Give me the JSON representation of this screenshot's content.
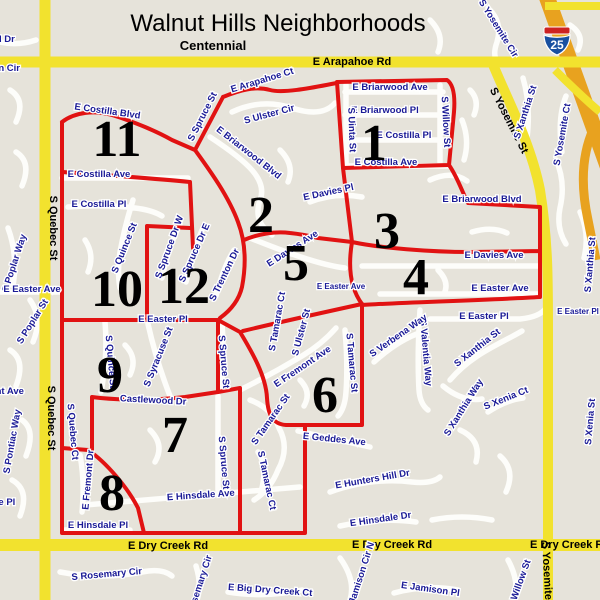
{
  "title": "Walnut Hills Neighborhoods",
  "subtitle": "Centennial",
  "interstate_shield": "25",
  "colors": {
    "background": "#e6e3da",
    "road_yellow": "#f2e22e",
    "highway_orange": "#e8a21f",
    "boundary_red": "#e11212",
    "street_label_blue": "#1a1a96",
    "shield_blue": "#1950a0",
    "shield_red": "#cc2222"
  },
  "regions": [
    {
      "number": "1",
      "x": 374,
      "y": 160
    },
    {
      "number": "2",
      "x": 261,
      "y": 232
    },
    {
      "number": "3",
      "x": 387,
      "y": 248
    },
    {
      "number": "4",
      "x": 416,
      "y": 294
    },
    {
      "number": "5",
      "x": 296,
      "y": 280
    },
    {
      "number": "6",
      "x": 325,
      "y": 412
    },
    {
      "number": "7",
      "x": 175,
      "y": 452
    },
    {
      "number": "8",
      "x": 112,
      "y": 510
    },
    {
      "number": "9",
      "x": 110,
      "y": 392
    },
    {
      "number": "10",
      "x": 117,
      "y": 306
    },
    {
      "number": "11",
      "x": 117,
      "y": 156
    },
    {
      "number": "12",
      "x": 184,
      "y": 303
    }
  ],
  "labels": [
    {
      "t": "Walnut Hills Neighborhoods",
      "x": 278,
      "y": 31,
      "r": 0,
      "c": "title"
    },
    {
      "t": "Centennial",
      "x": 213,
      "y": 50,
      "r": 0,
      "c": "sub"
    },
    {
      "t": "E Arapahoe Rd",
      "x": 352,
      "y": 65,
      "r": 0,
      "c": "maj"
    },
    {
      "t": "E Dry Creek Rd",
      "x": 168,
      "y": 549,
      "r": 0,
      "c": "maj"
    },
    {
      "t": "E Dry Creek Rd",
      "x": 392,
      "y": 548,
      "r": 0,
      "c": "maj"
    },
    {
      "t": "E Dry Creek Rd",
      "x": 570,
      "y": 548,
      "r": 0,
      "c": "maj",
      "a": "s"
    },
    {
      "t": "S Quebec St",
      "x": 50,
      "y": 228,
      "r": 90,
      "c": "maj"
    },
    {
      "t": "S Quebec St",
      "x": 48,
      "y": 418,
      "r": 90,
      "c": "maj"
    },
    {
      "t": "S Yosemite St",
      "x": 506,
      "y": 122,
      "r": 63,
      "c": "maj"
    },
    {
      "t": "S Yosemite St",
      "x": 544,
      "y": 578,
      "r": 87,
      "c": "maj"
    },
    {
      "t": "ld Dr",
      "x": 4,
      "y": 42,
      "r": 0,
      "a": "s"
    },
    {
      "t": "cton Cir",
      "x": 2,
      "y": 71,
      "r": 0,
      "a": "s"
    },
    {
      "t": "E Briarwood Ave",
      "x": 390,
      "y": 90,
      "r": 0
    },
    {
      "t": "E Briarwood Pl",
      "x": 385,
      "y": 113,
      "r": 0
    },
    {
      "t": "E Costilla Pl",
      "x": 404,
      "y": 138,
      "r": 0
    },
    {
      "t": "E Costilla Ave",
      "x": 386,
      "y": 165,
      "r": 0
    },
    {
      "t": "S Uinta St",
      "x": 349,
      "y": 130,
      "r": 88
    },
    {
      "t": "S Willow St",
      "x": 443,
      "y": 122,
      "r": 87
    },
    {
      "t": "S Xanthia St",
      "x": 528,
      "y": 113,
      "r": -72
    },
    {
      "t": "S Yosemite Ct",
      "x": 565,
      "y": 135,
      "r": -80
    },
    {
      "t": "S Yosemite Cir",
      "x": 496,
      "y": 30,
      "r": 58
    },
    {
      "t": "E Arapahoe Ct",
      "x": 263,
      "y": 83,
      "r": -17
    },
    {
      "t": "S Spruce St",
      "x": 205,
      "y": 118,
      "r": -63
    },
    {
      "t": "S Ulster Cir",
      "x": 270,
      "y": 117,
      "r": -15
    },
    {
      "t": "E Briarwood Blvd",
      "x": 247,
      "y": 155,
      "r": 38
    },
    {
      "t": "E Davies Pl",
      "x": 329,
      "y": 195,
      "r": -12
    },
    {
      "t": "E Briarwood Blvd",
      "x": 482,
      "y": 202,
      "r": 0
    },
    {
      "t": "E Davies Ave",
      "x": 494,
      "y": 258,
      "r": 0
    },
    {
      "t": "E Easter Ave",
      "x": 500,
      "y": 291,
      "r": 0
    },
    {
      "t": "E Easter Pl",
      "x": 484,
      "y": 319,
      "r": 0
    },
    {
      "t": "E Easter Pl",
      "x": 578,
      "y": 314,
      "r": 0,
      "c": "sm"
    },
    {
      "t": "E Davies Ave",
      "x": 294,
      "y": 251,
      "r": -33
    },
    {
      "t": "E Easter Ave",
      "x": 341,
      "y": 289,
      "r": 0,
      "c": "sm"
    },
    {
      "t": "S Tamarac Ct",
      "x": 280,
      "y": 322,
      "r": -80
    },
    {
      "t": "S Ulster St",
      "x": 304,
      "y": 333,
      "r": -75
    },
    {
      "t": "E Costilla Blvd",
      "x": 107,
      "y": 114,
      "r": 8
    },
    {
      "t": "E Costilla Ave",
      "x": 99,
      "y": 177,
      "r": 0
    },
    {
      "t": "E Costilla Pl",
      "x": 99,
      "y": 207,
      "r": 0
    },
    {
      "t": "S Quince St",
      "x": 127,
      "y": 249,
      "r": -68
    },
    {
      "t": "S Spruce Dr W",
      "x": 172,
      "y": 248,
      "r": -70
    },
    {
      "t": "S Spruce Dr E",
      "x": 197,
      "y": 254,
      "r": -66
    },
    {
      "t": "S Trenton Dr",
      "x": 227,
      "y": 276,
      "r": -64
    },
    {
      "t": "S Poplar Way",
      "x": 17,
      "y": 264,
      "r": -72
    },
    {
      "t": "S Poplar St",
      "x": 35,
      "y": 323,
      "r": -58
    },
    {
      "t": "E Easter Ave",
      "x": 32,
      "y": 292,
      "r": 0
    },
    {
      "t": "amont Ave",
      "x": 0,
      "y": 394,
      "r": 0,
      "a": "s"
    },
    {
      "t": "S Pontiac Way",
      "x": 15,
      "y": 442,
      "r": -80
    },
    {
      "t": "S Quebec Ct",
      "x": 70,
      "y": 432,
      "r": 85
    },
    {
      "t": "dale Pl",
      "x": 0,
      "y": 505,
      "r": 0,
      "a": "s"
    },
    {
      "t": "E Easter Pl",
      "x": 163,
      "y": 322,
      "r": 0
    },
    {
      "t": "S Quince St",
      "x": 108,
      "y": 362,
      "r": 85
    },
    {
      "t": "S Syracuse St",
      "x": 161,
      "y": 358,
      "r": -68
    },
    {
      "t": "S Spruce St",
      "x": 221,
      "y": 362,
      "r": 85
    },
    {
      "t": "Castlewood Dr",
      "x": 153,
      "y": 403,
      "r": 3
    },
    {
      "t": "E Fremont Ave",
      "x": 304,
      "y": 369,
      "r": -34
    },
    {
      "t": "E Fremont Dr",
      "x": 91,
      "y": 480,
      "r": -85
    },
    {
      "t": "S Tamarac St",
      "x": 273,
      "y": 421,
      "r": -55
    },
    {
      "t": "S Tamarac St",
      "x": 349,
      "y": 363,
      "r": 85
    },
    {
      "t": "S Tamarac Ct",
      "x": 264,
      "y": 481,
      "r": 78
    },
    {
      "t": "S Spruce St",
      "x": 221,
      "y": 463,
      "r": 85
    },
    {
      "t": "E Hinsdale Ave",
      "x": 201,
      "y": 498,
      "r": -4
    },
    {
      "t": "E Hinsdale Pl",
      "x": 98,
      "y": 528,
      "r": 0
    },
    {
      "t": "E Geddes Ave",
      "x": 334,
      "y": 442,
      "r": 6
    },
    {
      "t": "S Valentia Way",
      "x": 423,
      "y": 353,
      "r": 85
    },
    {
      "t": "S Verbena Way",
      "x": 400,
      "y": 338,
      "r": -35
    },
    {
      "t": "S Xanthia St",
      "x": 479,
      "y": 350,
      "r": -38
    },
    {
      "t": "S Xanthia Way",
      "x": 466,
      "y": 409,
      "r": -58
    },
    {
      "t": "S Xenia Ct",
      "x": 507,
      "y": 401,
      "r": -22
    },
    {
      "t": "S Xanthia St",
      "x": 593,
      "y": 265,
      "r": -85
    },
    {
      "t": "S Xenia St",
      "x": 593,
      "y": 422,
      "r": -85
    },
    {
      "t": "E Hunters Hill Dr",
      "x": 373,
      "y": 482,
      "r": -10
    },
    {
      "t": "E Hinsdale Dr",
      "x": 381,
      "y": 522,
      "r": -8
    },
    {
      "t": "S Willow St",
      "x": 522,
      "y": 585,
      "r": -70
    },
    {
      "t": "S Rosemary Cir",
      "x": 107,
      "y": 577,
      "r": -5
    },
    {
      "t": "S Rosemary Cir",
      "x": 201,
      "y": 590,
      "r": -72
    },
    {
      "t": "E Big Dry Creek Ct",
      "x": 270,
      "y": 593,
      "r": 4
    },
    {
      "t": "S Jamison Cir N",
      "x": 363,
      "y": 578,
      "r": -72
    },
    {
      "t": "E Jamison Pl",
      "x": 430,
      "y": 592,
      "r": 8
    }
  ]
}
